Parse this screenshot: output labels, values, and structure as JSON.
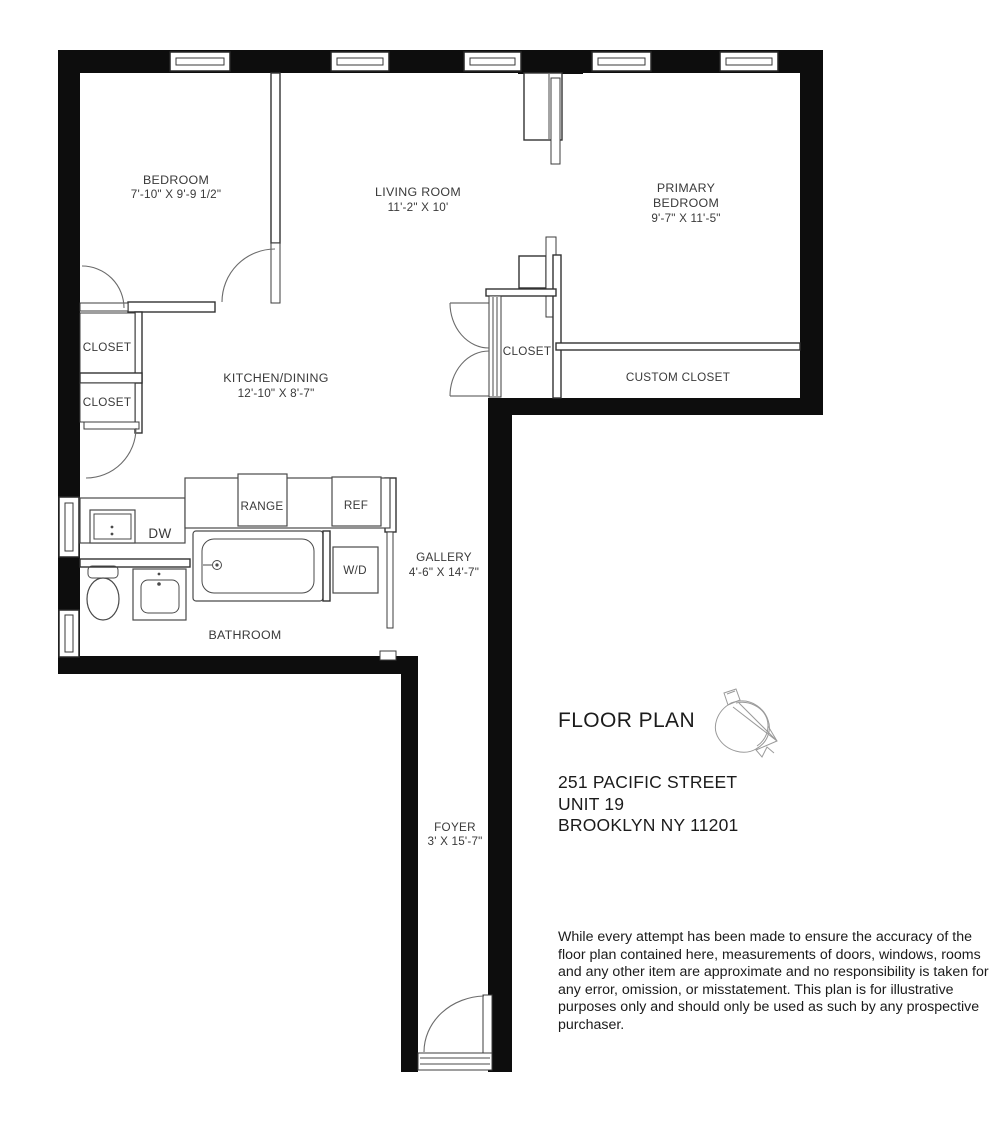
{
  "title_block": {
    "title": "FLOOR PLAN",
    "address": [
      "251 PACIFIC STREET",
      "UNIT 19",
      "BROOKLYN NY 11201"
    ],
    "disclaimer": "While every attempt has been made to ensure the accuracy of the floor plan contained here, measurements of doors, windows, rooms and any other item are approximate and no responsibility is taken for any error, omission, or misstatement. This plan is for illustrative purposes only and should only be used as such by any prospective purchaser."
  },
  "rooms": {
    "bedroom": {
      "label": "BEDROOM",
      "dims": "7'-10\" X 9'-9 1/2\""
    },
    "living_room": {
      "label": "LIVING ROOM",
      "dims": "11'-2\" X 10'"
    },
    "primary_bedroom": {
      "label_line1": "PRIMARY",
      "label_line2": "BEDROOM",
      "dims": "9'-7\" X 11'-5\""
    },
    "kitchen_dining": {
      "label": "KITCHEN/DINING",
      "dims": "12'-10\" X 8'-7\""
    },
    "gallery": {
      "label": "GALLERY",
      "dims": "4'-6\" X 14'-7\""
    },
    "bathroom": {
      "label": "BATHROOM"
    },
    "foyer": {
      "label": "FOYER",
      "dims": "3' X 15'-7\""
    },
    "closet_bedroom": {
      "label": "CLOSET"
    },
    "closet_hall": {
      "label": "CLOSET"
    },
    "closet_primary": {
      "label": "CLOSET"
    },
    "custom_closet": {
      "label": "CUSTOM CLOSET"
    }
  },
  "fixtures": {
    "range": "RANGE",
    "refrigerator": "REF",
    "dishwasher": "DW",
    "washer_dryer": "W/D"
  },
  "colors": {
    "wall": "#0d0d0d",
    "line": "#323232",
    "text": "#3a3a3a",
    "title_text": "#1b1b1b",
    "background": "#ffffff"
  }
}
